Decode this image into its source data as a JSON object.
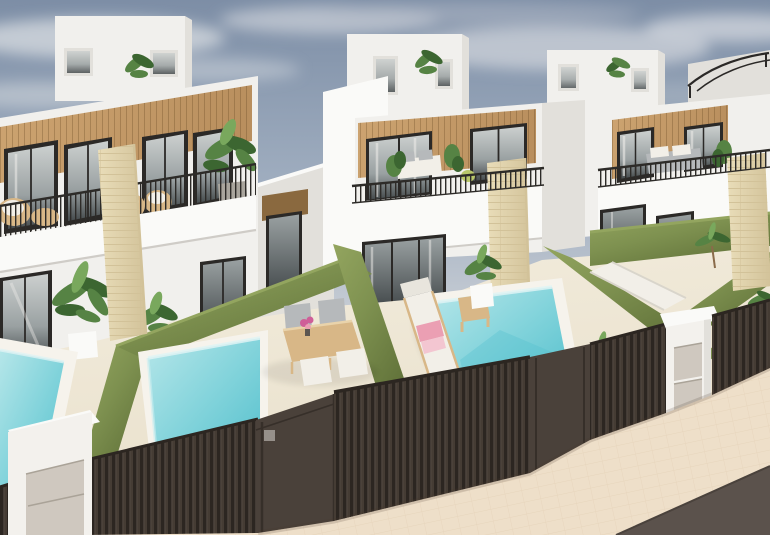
{
  "image": {
    "alt": "Aerial 3D render of a row of new-build two-storey white villas with wood-clad upper facades, black-framed windows, balconies with thin black railings, beige stone chimney columns, walled front gardens with green hedge-topped walls, private turquoise plunge pools, sun loungers and outdoor dining furniture, dark brown slatted fences and gates along a beige tiled sidewalk with an asphalt road in the lower right corner, under a hazy blue-grey sky.",
    "width": 770,
    "height": 535
  },
  "scene": {
    "objects": [
      "sky",
      "clouds",
      "background-building",
      "roof-pergola",
      "house-left",
      "house-center",
      "house-right",
      "connector-wall",
      "rooftop-box",
      "wood-cladding",
      "upper-window",
      "ground-window",
      "glass-door",
      "balcony-railing",
      "balcony-slab",
      "stone-column",
      "entry-soffit",
      "entry-door",
      "hedge-wall",
      "pool",
      "pool-coping",
      "terrace",
      "dining-table",
      "dining-chair",
      "sun-lounger",
      "side-table",
      "towels",
      "flower-vase",
      "potted-plant",
      "palm-plant",
      "monstera-plant",
      "rattan-chair",
      "fence",
      "gate-solid-panel",
      "gate-keypad",
      "utility-cabinet",
      "utility-pillar",
      "meter-panel",
      "sidewalk",
      "road"
    ]
  },
  "colors": {
    "sky_top": "#7d8ea6",
    "sky_mid": "#9fadbf",
    "sky_low": "#c6ccd4",
    "cloud": "#dadde2",
    "cloud_shadow": "#aeb7c4",
    "wall_bright": "#fafaf8",
    "wall_white": "#f1f0ed",
    "wall_shade": "#e2e0db",
    "wall_dark": "#cfccc7",
    "wood": "#b98f5e",
    "wood_light": "#cda471",
    "wood_dark": "#8f6a3c",
    "stone": "#e9ddb9",
    "stone_line": "#d2c299",
    "frame_dark": "#2b2927",
    "glass_light": "#ccd0cf",
    "glass_mid": "#9aa1a2",
    "glass_dark": "#454b4d",
    "curtain_white": "#efedea",
    "railing": "#2d2b28",
    "hedge": "#7e9150",
    "hedge_light": "#93a55f",
    "hedge_dark": "#5f7038",
    "pool_light": "#b5e6e9",
    "pool_mid": "#7fd2da",
    "pool_deep": "#54c0cd",
    "pool_coping": "#f6f3ec",
    "terrace": "#f3edde",
    "terrace_shade": "#e8dfca",
    "fence": "#453c34",
    "fence_slat_dark": "#2c2621",
    "fence_slat_light": "#5a5048",
    "gate_panel": "#4a413a",
    "gate_panel_dark": "#362f29",
    "keypad": "#96908a",
    "cabinet": "#f3f1ed",
    "metal": "#cfc8bf",
    "metal_line": "#aaa398",
    "sidewalk": "#eedfc9",
    "sidewalk_line": "#ddc8ab",
    "road": "#5b524c",
    "plant": "#568344",
    "plant_dark": "#3c6631",
    "plant_light": "#79a85d",
    "plant_yellow": "#b9c76a",
    "trunk": "#8a6b4a",
    "furniture_wood": "#d8b787",
    "cushion_white": "#f2efe8",
    "cushion_gray": "#b6b9bb",
    "towel_pink": "#eb9fb3",
    "towel_pink_light": "#f3c6d1",
    "flower_pink": "#cf5e98",
    "pot_gray": "#a9a59d",
    "soffit": "#8a693f"
  }
}
